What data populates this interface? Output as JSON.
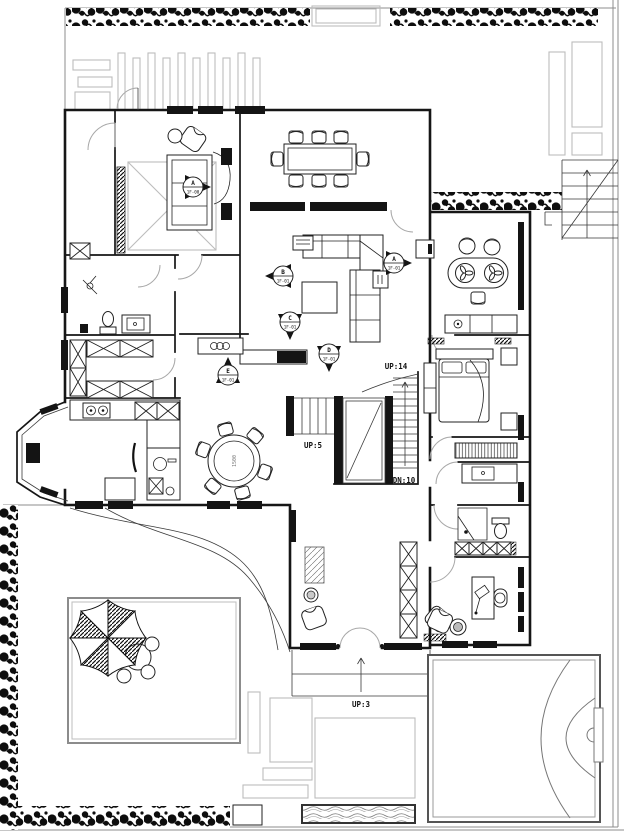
{
  "plan": {
    "elevation_markers": [
      {
        "letter": "A",
        "level": "1F-00",
        "location": "bedroom-1",
        "direction": "right"
      },
      {
        "letter": "A",
        "level": "1F-01",
        "location": "living-room",
        "direction": "right"
      },
      {
        "letter": "B",
        "level": "1F-01",
        "location": "living-room",
        "direction": "left"
      },
      {
        "letter": "C",
        "level": "1F-01",
        "location": "living-room",
        "direction": "down"
      },
      {
        "letter": "D",
        "level": "1F-01",
        "location": "living-room",
        "direction": "down"
      },
      {
        "letter": "E",
        "level": "1F-01",
        "location": "hallway",
        "direction": "up"
      }
    ],
    "stair_labels": {
      "main_up": "UP:14",
      "entry_up": "UP:5",
      "main_down": "DN:10",
      "porch_up": "UP:3"
    },
    "annotations": {
      "dining_table_diameter": "1500"
    },
    "colors": {
      "ink": "#161616",
      "light_gray": "#bdbdbd",
      "mid_gray": "#8c8c8c",
      "background": "#ffffff"
    }
  }
}
